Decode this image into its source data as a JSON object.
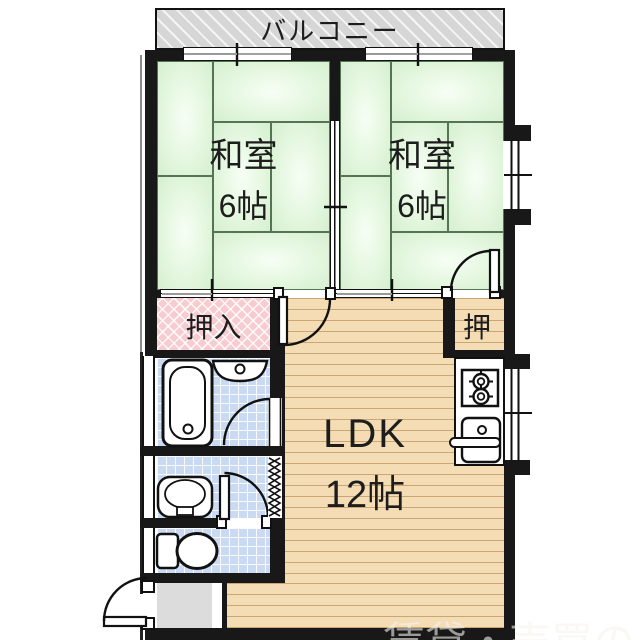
{
  "balcony": {
    "label": "バルコニー"
  },
  "rooms": {
    "washitsu_left": {
      "name": "和室",
      "size": "6帖"
    },
    "washitsu_right": {
      "name": "和室",
      "size": "6帖"
    },
    "ldk": {
      "name": "LDK",
      "size": "12帖"
    },
    "closet_left": {
      "label": "押入"
    },
    "closet_right": {
      "label": "押"
    }
  },
  "fixtures": [
    "bathtub",
    "bathroom-sink",
    "washbasin",
    "toilet",
    "stove",
    "kitchen-sink"
  ],
  "watermark": "賃貸・売買の",
  "colors": {
    "tatami_green": "#ddf2d7",
    "closet_pink": "#f6ccd1",
    "tile_blue": "#c9daf2",
    "floor_tan": "#f4dcb4",
    "wall_black": "#181818",
    "balcony_gray": "#d6d6d6",
    "genkan_gray": "#dcdcdc"
  }
}
